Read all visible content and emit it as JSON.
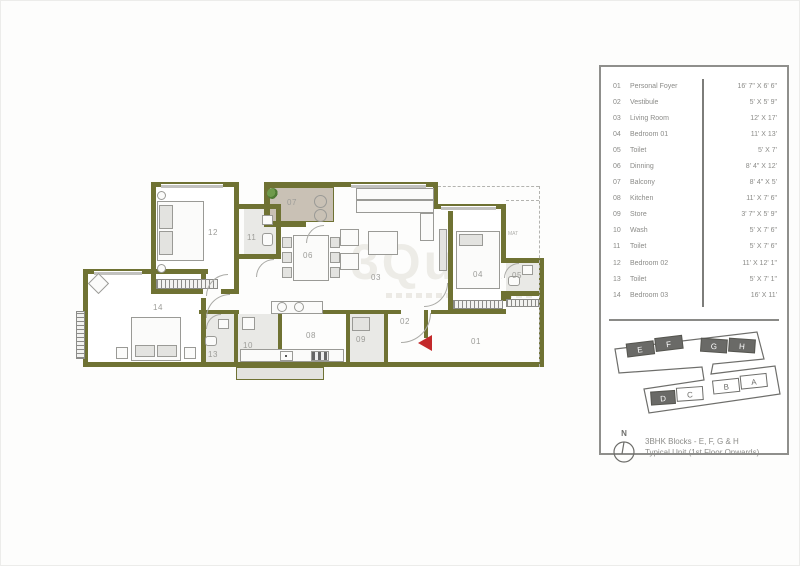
{
  "plan": {
    "labels": [
      "01",
      "02",
      "03",
      "04",
      "05",
      "06",
      "07",
      "08",
      "09",
      "10",
      "11",
      "12",
      "13",
      "14"
    ],
    "mat_label": "MAT",
    "watermark": "3Quik",
    "colors": {
      "wall": "#6f7233",
      "balcony_floor": "#c9c1b5",
      "entry_arrow": "#c3292b"
    }
  },
  "legend": {
    "rows": [
      {
        "no": "01",
        "name": "Personal Foyer",
        "dim": "16' 7\" X 6' 6\""
      },
      {
        "no": "02",
        "name": "Vestibule",
        "dim": "5' X 5' 9\""
      },
      {
        "no": "03",
        "name": "Living Room",
        "dim": "12' X 17'"
      },
      {
        "no": "04",
        "name": "Bedroom 01",
        "dim": "11' X 13'"
      },
      {
        "no": "05",
        "name": "Toilet",
        "dim": "5' X 7'"
      },
      {
        "no": "06",
        "name": "Dinning",
        "dim": "8' 4\" X 12'"
      },
      {
        "no": "07",
        "name": "Balcony",
        "dim": "8' 4\" X 5'"
      },
      {
        "no": "08",
        "name": "Kitchen",
        "dim": "11' X 7' 6\""
      },
      {
        "no": "09",
        "name": "Store",
        "dim": "3' 7\" X 5' 9\""
      },
      {
        "no": "10",
        "name": "Wash",
        "dim": "5' X 7' 6\""
      },
      {
        "no": "11",
        "name": "Toilet",
        "dim": "5' X 7' 6\""
      },
      {
        "no": "12",
        "name": "Bedroom 02",
        "dim": "11' X 12' 1\""
      },
      {
        "no": "13",
        "name": "Toilet",
        "dim": "5' X 7' 1\""
      },
      {
        "no": "14",
        "name": "Bedroom 03",
        "dim": "16' X 11'"
      }
    ]
  },
  "keyplan": {
    "blocks": {
      "e": "E",
      "f": "F",
      "g": "G",
      "h": "H",
      "b": "B",
      "a": "A",
      "d": "D",
      "c": "C"
    },
    "north_label": "N",
    "caption_line1": "3BHK Blocks - E, F, G & H",
    "caption_line2": "Typical Unit (1st Floor Onwards)"
  }
}
